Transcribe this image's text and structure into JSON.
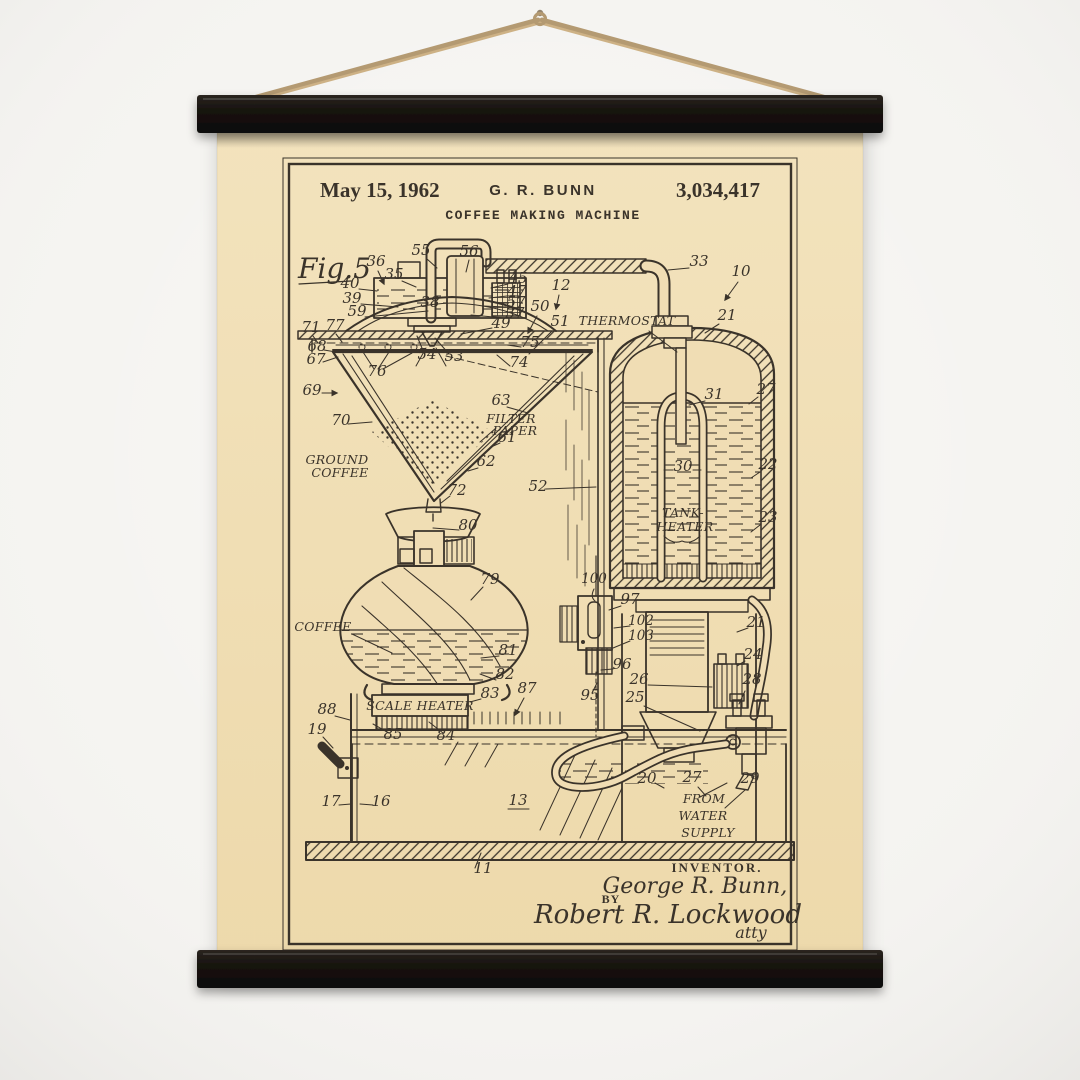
{
  "poster": {
    "date": "May 15, 1962",
    "inventor": "G. R. BUNN",
    "patent_number": "3,034,417",
    "title": "COFFEE MAKING MACHINE",
    "figure_label": "Fig.5"
  },
  "labels": {
    "thermostat": "THERMOSTAT",
    "filter_line1": "FILTER",
    "filter_line2": "PAPER",
    "ground_line1": "GROUND",
    "ground_line2": "COFFEE",
    "coffee": "COFFEE",
    "scale_heater": "SCALE HEATER",
    "tank_heater_line1": "TANK-",
    "tank_heater_line2": "HEATER",
    "water_line1": "FROM",
    "water_line2": "WATER",
    "water_line3": "SUPPLY"
  },
  "signature": {
    "caption": "INVENTOR.",
    "inventor_name": "George R. Bunn,",
    "by": "BY",
    "attorney": "Robert R. Lockwood",
    "initials": "atty"
  },
  "refs": {
    "10": "10",
    "11": "11",
    "12": "12",
    "13": "13",
    "16": "16",
    "17": "17",
    "19": "19",
    "20": "20",
    "21": "21",
    "22": "22",
    "23": "23",
    "24": "24",
    "25": "25",
    "26": "26",
    "27": "27",
    "28": "28",
    "29": "29",
    "30": "30",
    "31": "31",
    "33": "33",
    "35": "35",
    "36": "36",
    "37": "37",
    "38": "38",
    "39": "39",
    "40": "40",
    "45": "45",
    "47": "47",
    "49": "49",
    "50": "50",
    "51": "51",
    "52": "52",
    "53": "53",
    "54": "54",
    "55": "55",
    "56": "56",
    "57": "57",
    "59": "59",
    "61": "61",
    "62": "62",
    "63": "63",
    "67": "67",
    "68": "68",
    "69": "69",
    "70": "70",
    "71": "71",
    "72": "72",
    "74": "74",
    "75": "75",
    "76": "76",
    "77": "77",
    "79": "79",
    "80": "80",
    "81": "81",
    "82": "82",
    "83": "83",
    "84": "84",
    "85": "85",
    "87": "87",
    "88": "88",
    "95": "95",
    "96": "96",
    "97": "97",
    "100": "100",
    "102": "102",
    "103": "103"
  },
  "colors": {
    "wall": "#f5f4f1",
    "paper": "#f1ddb4",
    "ink": "#3a332a",
    "hanger_bar": "#16120e",
    "twine": "#c2a67c"
  }
}
